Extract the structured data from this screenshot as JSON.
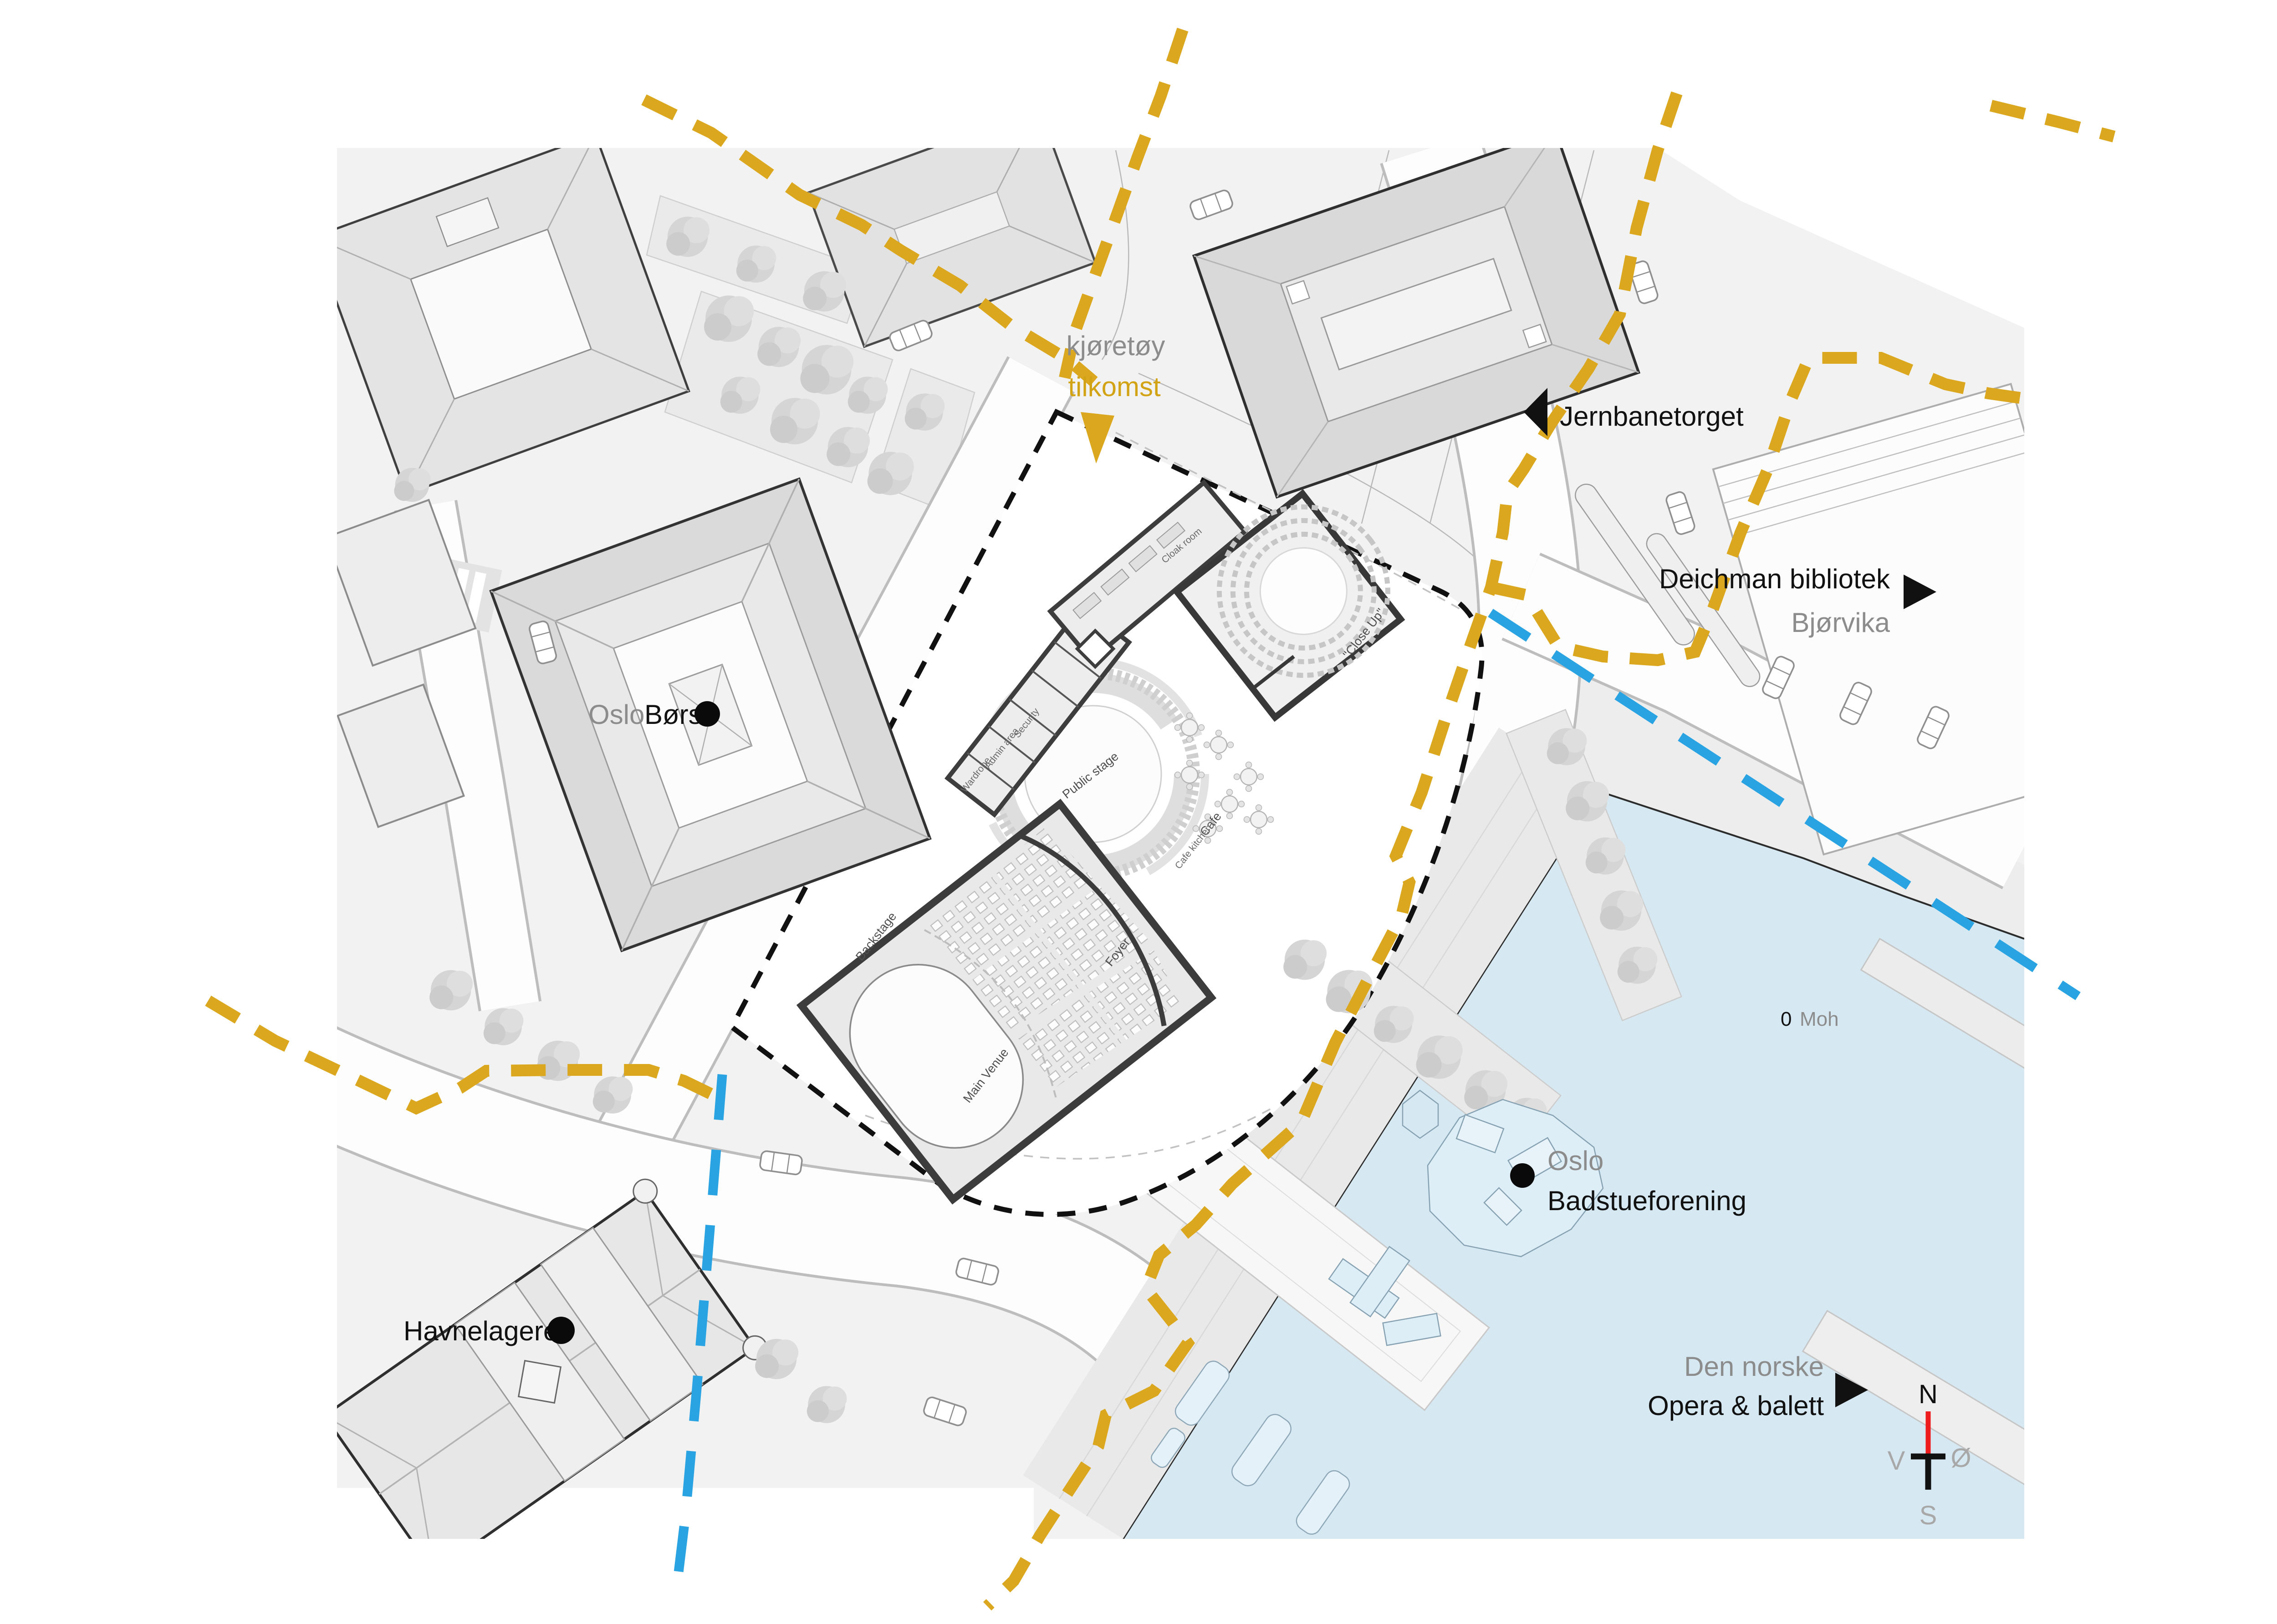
{
  "map": {
    "colors": {
      "water": "#d6e9f3",
      "ground": "#f2f2f2",
      "building": "#e3e3e3",
      "route_yellow": "#dba71e",
      "flood_line_blue": "#2aa3e2",
      "site_boundary_black": "#111111",
      "compass_north_red": "#ee1c1c"
    },
    "annotations": {
      "vehicle_access": {
        "line1": "kjøretøy",
        "line2": "tilkomst"
      },
      "jernbanetorget": {
        "label": "Jernbanetorget"
      },
      "deichman": {
        "line1": "Deichman bibliotek",
        "line2": "Bjørvika"
      },
      "oslo_bors": {
        "word1": "Oslo",
        "word2": "Børs"
      },
      "sea_level": {
        "value": "0",
        "unit": "Moh"
      },
      "badstueforening": {
        "line1": "Oslo",
        "line2": "Badstueforening"
      },
      "havnelageret": {
        "label": "Havnelageret"
      },
      "opera": {
        "line1": "Den norske",
        "line2": "Opera & balett"
      }
    },
    "plan_labels": {
      "cloak_room": "Cloak room",
      "wardrobe": "Wardrobe",
      "admin_area": "Admin area",
      "security": "Security",
      "close_up": "\"Close Up\"",
      "cafe": "Cafe",
      "cafe_kitchen": "Cafe kitchen",
      "public_stage": "Public stage",
      "backstage": "Backstage",
      "main_venue": "Main Venue",
      "foyer": "Foyer"
    },
    "compass": {
      "north": "N",
      "west": "V",
      "east": "Ø",
      "south": "S"
    }
  }
}
